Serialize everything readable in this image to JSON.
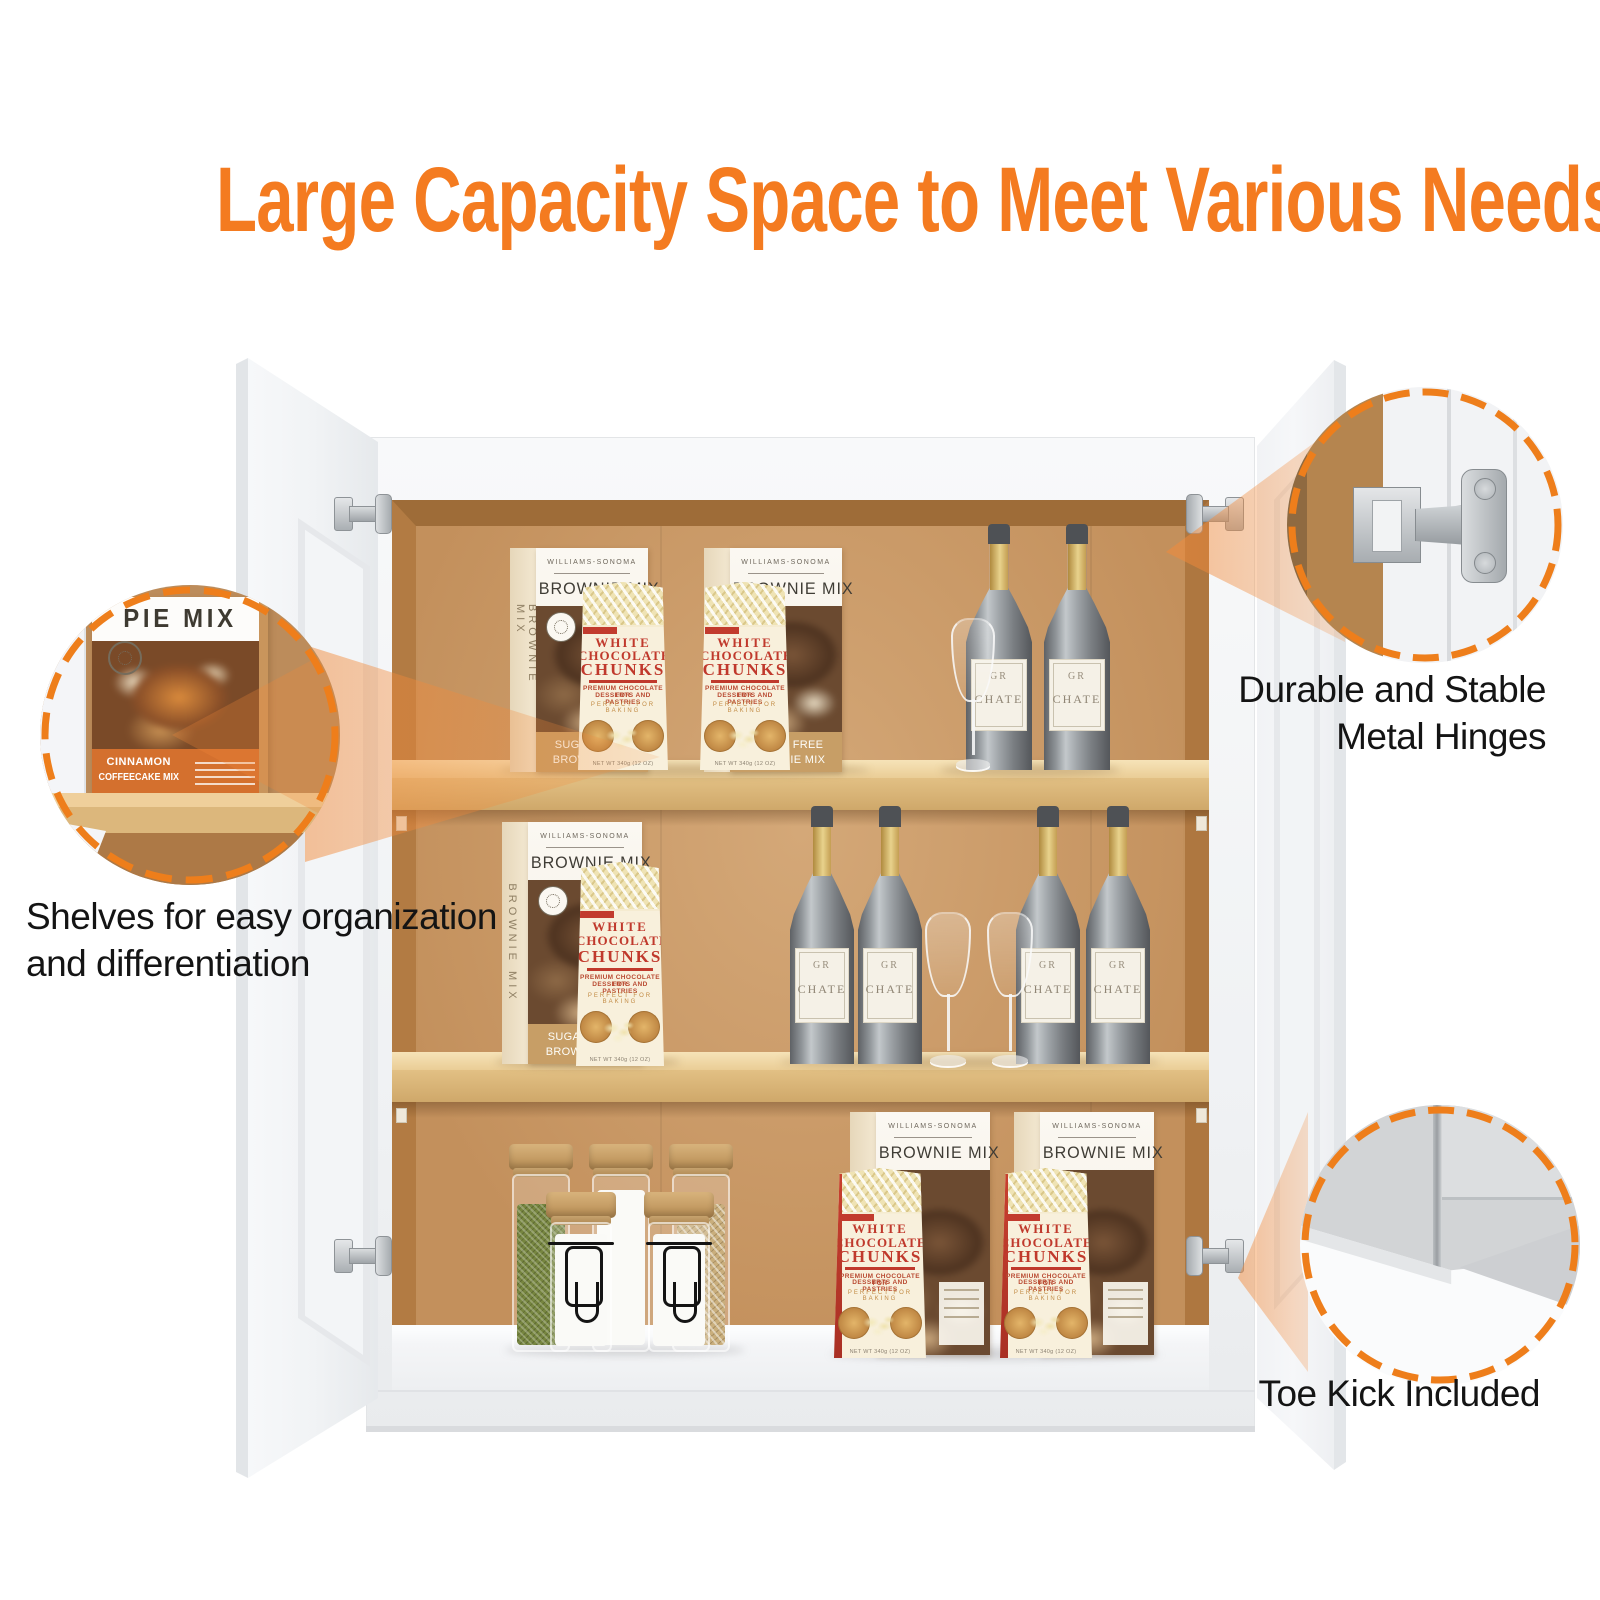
{
  "headline": {
    "text": "Large Capacity Space to Meet Various Needs",
    "color": "#F47B20"
  },
  "callouts": {
    "shelves": {
      "line1": "Shelves for easy organization",
      "line2": "and differentiation",
      "closeup": "pie-mix-box-on-shelf"
    },
    "hinges": {
      "line1": "Durable and Stable",
      "line2": "Metal Hinges",
      "closeup": "concealed-metal-hinge"
    },
    "toe_kick": {
      "label": "Toe Kick Included",
      "closeup": "door-panel-corner"
    }
  },
  "products": {
    "brownie_box": {
      "brand": "WILLIAMS-SONOMA",
      "title": "BROWNIE MIX",
      "side_text": "BROWNIE MIX",
      "sugar_line1": "SUGAR FREE",
      "sugar_line2": "BROWNIE MIX"
    },
    "chunks_bag": {
      "title1": "WHITE",
      "title2": "CHOCOLATE",
      "title3": "CHUNKS",
      "sub1": "PREMIUM CHOCOLATE FOR",
      "sub2": "DESSERTS AND PASTRIES",
      "tagline": "PERFECT FOR BAKING",
      "net": "NET WT 340g (12 OZ)"
    },
    "pie_box": {
      "title": "PIE MIX",
      "band_line1": "CINNAMON",
      "band_line2": "COFFEECAKE MIX"
    },
    "wine_bottle": {
      "label_line1": "GR",
      "label_line2": "CHATE"
    }
  },
  "icons": {
    "callout_rings": "dashed-orange-circle",
    "beams": "orange-highlight-beam"
  },
  "colors": {
    "accent_orange": "#F47B20",
    "callout_dash": "#EE7E1B",
    "interior_wood": "#C99B6B",
    "shelf_wood": "#DEBA7D",
    "bag_red": "#C23B2E",
    "label_text": "#141414"
  }
}
